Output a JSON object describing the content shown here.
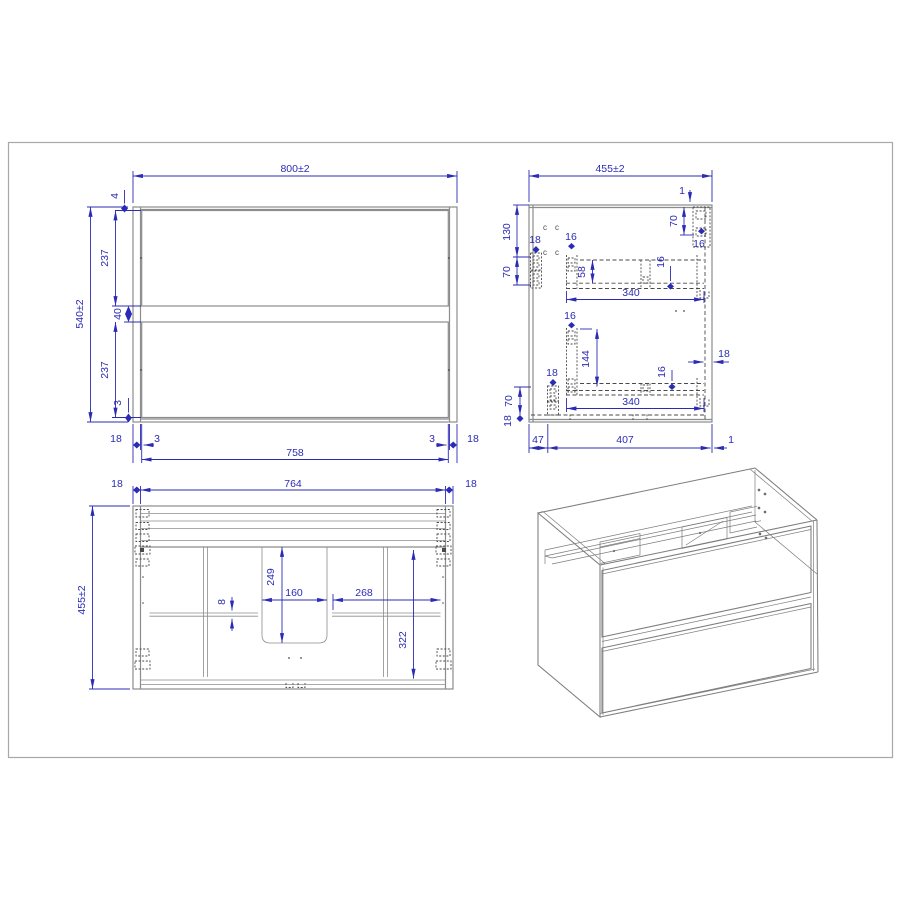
{
  "page": {
    "background": "#ffffff",
    "frame_color": "#a8a8a8",
    "dimension_color": "#2b2bb5",
    "drawing_line_color": "#8c8c8c",
    "hidden_detail_color": "#4a4a4a",
    "description": "Furniture technical drawing of a wall-hung two-drawer vanity cabinet: front view, side section view, top view and isometric view"
  },
  "views": {
    "front": {
      "title": "front-view",
      "dims": {
        "overall_width": "800±2",
        "overall_height": "540±2",
        "top_gap": "4",
        "drawer1_height": "237",
        "mid_gap": "40",
        "drawer2_height": "237",
        "bottom_gap": "3",
        "left_panel": "18",
        "left_reveal": "3",
        "front_width": "758",
        "right_reveal": "3",
        "right_panel": "18"
      }
    },
    "side": {
      "title": "side-view",
      "dims": {
        "overall_depth": "455±2",
        "top_back_gap": "1",
        "hanger_offset": "70",
        "hanger_16": "16",
        "front_130": "130",
        "front_70": "70",
        "bracket1_18": "18",
        "slide1_16": "16",
        "slide1_58": "58",
        "slide1_len": "340",
        "slide1_bot_16": "16",
        "slide2_16": "16",
        "slide2_144": "144",
        "back_panel_18": "18",
        "slide2_bot_16": "16",
        "slide2_len": "340",
        "bracket2_18": "18",
        "bottom_70": "70",
        "bottom_18": "18",
        "depth_47": "47",
        "depth_407": "407",
        "depth_1": "1",
        "hole_mark": "c"
      }
    },
    "top": {
      "title": "top-view",
      "dims": {
        "left_panel": "18",
        "inner_width": "764",
        "right_panel": "18",
        "overall_depth": "455±2",
        "cutout_depth": "249",
        "cutout_width": "160",
        "right_span": "268",
        "bar_thickness": "8",
        "inner_depth": "322"
      }
    },
    "iso": {
      "title": "isometric-view"
    }
  }
}
